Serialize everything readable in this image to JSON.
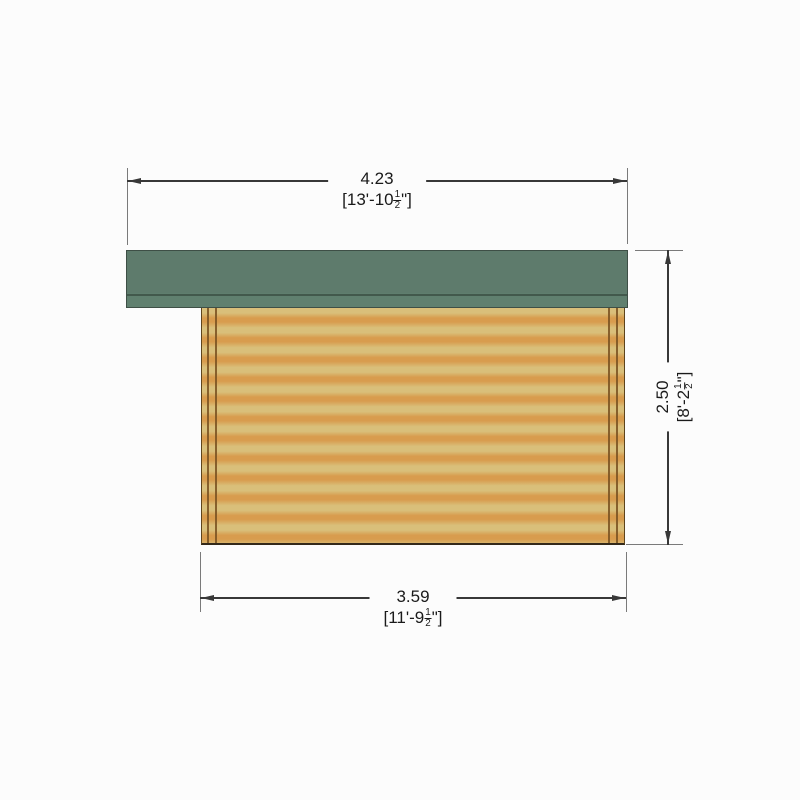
{
  "theme": {
    "bg": "#fcfcfc",
    "roof-green": "#5e7b6c",
    "roof-edge": "#3e4f46",
    "roof-divider": "#42594c",
    "wood-light": "#d9bf7a",
    "wood-dark": "#d89c4e",
    "wood-post": "#7d5524",
    "wood-outline": "#5d441c",
    "wall-base": "#33291a",
    "dim-line": "#383838",
    "ext-line": "#7a7a7a",
    "text": "#1a1a1a"
  },
  "dimensions": {
    "top": {
      "metric": "4.23",
      "imperial_prefix": "[13'-10",
      "fraction_numerator": "1",
      "fraction_denominator": "2",
      "imperial_suffix": "\"]"
    },
    "right": {
      "metric": "2.50",
      "imperial_prefix": "[8'-2",
      "fraction_numerator": "1",
      "fraction_denominator": "2",
      "imperial_suffix": "\"]"
    },
    "bottom": {
      "metric": "3.59",
      "imperial_prefix": "[11'-9",
      "fraction_numerator": "1",
      "fraction_denominator": "2",
      "imperial_suffix": "\"]"
    }
  }
}
